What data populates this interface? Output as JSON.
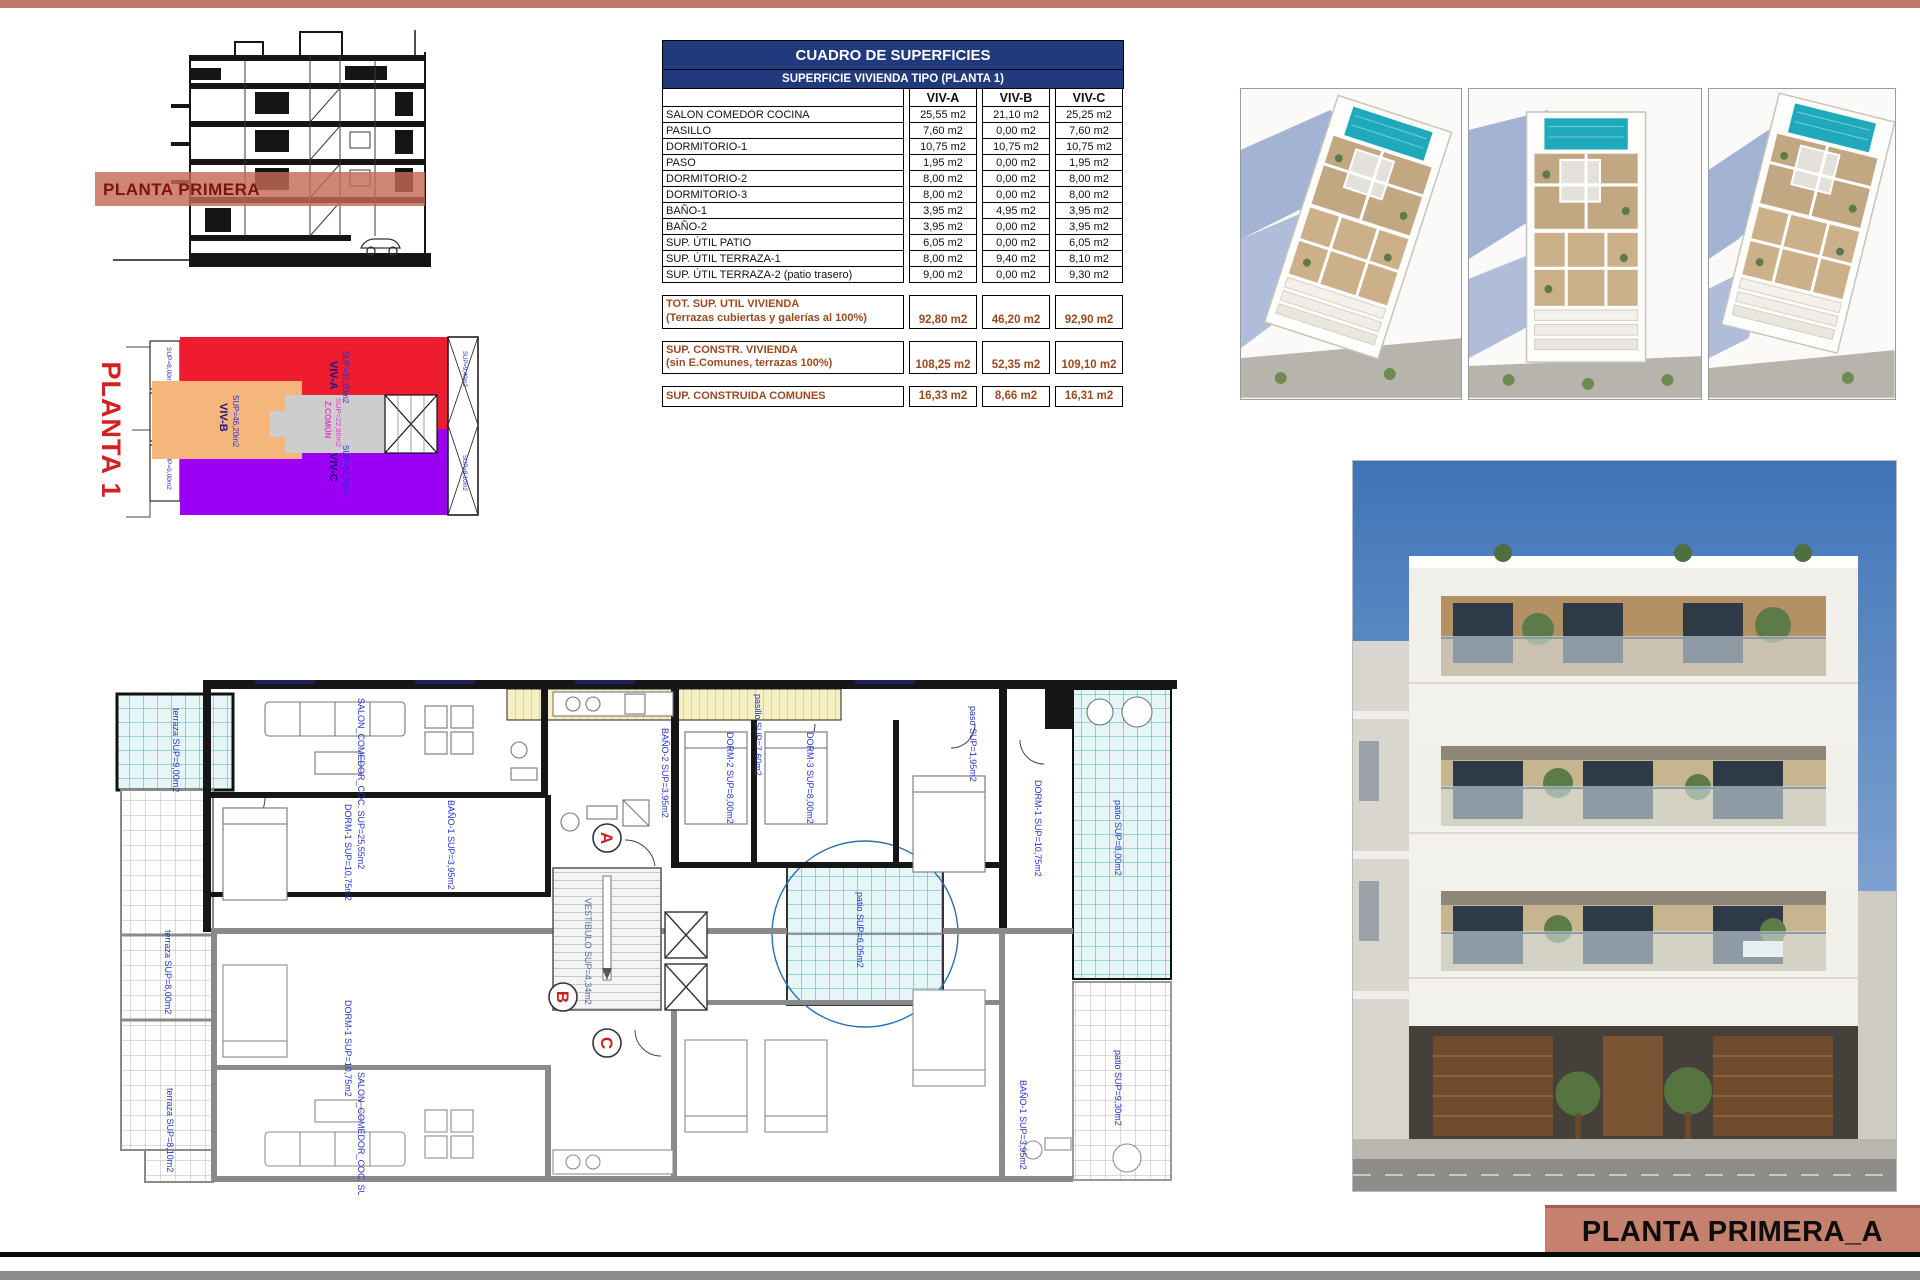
{
  "page": {
    "accent_color": "#bf7769",
    "background": "#ffffff"
  },
  "section_drawing": {
    "band_label": "PLANTA PRIMERA",
    "band_color": "#c46a58"
  },
  "key_plan": {
    "title": "PLANTA 1",
    "zones": [
      {
        "name": "VIV-A",
        "sup": "SUP=92,80m2",
        "color": "#ee1c2e"
      },
      {
        "name": "VIV-B",
        "sup": "SUP=46,20m2",
        "color": "#f5b67c"
      },
      {
        "name": "Z.COMÚN",
        "sup": "SUP=22,86m2",
        "color": "#cdcdcd"
      },
      {
        "name": "VIV-C",
        "sup": "SUP=92,90m2",
        "color": "#9b00f5"
      }
    ],
    "side_labels": [
      "SUP=8,00m2",
      "SUP=6,05m2",
      "SUP=9,00m2"
    ],
    "terrace_labels": [
      "SUP=9,40m2",
      "SUP=8,10m2"
    ]
  },
  "surfaces_table": {
    "title": "CUADRO DE SUPERFICIES",
    "subtitle": "SUPERFICIE VIVIENDA TIPO  (PLANTA 1)",
    "columns": [
      "VIV-A",
      "VIV-B",
      "VIV-C"
    ],
    "rows": [
      {
        "label": "SALON COMEDOR COCINA",
        "values": [
          "25,55 m2",
          "21,10 m2",
          "25,25 m2"
        ]
      },
      {
        "label": "PASILLO",
        "values": [
          "7,60 m2",
          "0,00 m2",
          "7,60 m2"
        ]
      },
      {
        "label": "DORMITORIO-1",
        "values": [
          "10,75 m2",
          "10,75 m2",
          "10,75 m2"
        ]
      },
      {
        "label": "PASO",
        "values": [
          "1,95 m2",
          "0,00 m2",
          "1,95 m2"
        ]
      },
      {
        "label": "DORMITORIO-2",
        "values": [
          "8,00 m2",
          "0,00 m2",
          "8,00 m2"
        ]
      },
      {
        "label": "DORMITORIO-3",
        "values": [
          "8,00 m2",
          "0,00 m2",
          "8,00 m2"
        ]
      },
      {
        "label": "BAÑO-1",
        "values": [
          "3,95 m2",
          "4,95 m2",
          "3,95 m2"
        ]
      },
      {
        "label": "BAÑO-2",
        "values": [
          "3,95 m2",
          "0,00 m2",
          "3,95 m2"
        ]
      },
      {
        "label": "SUP. ÚTIL PATIO",
        "values": [
          "6,05 m2",
          "0,00 m2",
          "6,05 m2"
        ]
      },
      {
        "label": "SUP. ÚTIL TERRAZA-1",
        "values": [
          "8,00 m2",
          "9,40 m2",
          "8,10 m2"
        ]
      },
      {
        "label": "SUP. ÚTIL TERRAZA-2 (patio trasero)",
        "values": [
          "9,00 m2",
          "0,00 m2",
          "9,30 m2"
        ]
      }
    ],
    "summary_rows": [
      {
        "label_line1": "TOT. SUP. UTIL VIVIENDA",
        "label_line2": "(Terrazas cubiertas y galerías al 100%)",
        "values": [
          "92,80 m2",
          "46,20 m2",
          "92,90 m2"
        ]
      },
      {
        "label_line1": "SUP. CONSTR. VIVIENDA",
        "label_line2": "(sin E.Comunes, terrazas 100%)",
        "values": [
          "108,25 m2",
          "52,35 m2",
          "109,10 m2"
        ]
      },
      {
        "label_line1": "SUP. CONSTRUIDA COMUNES",
        "label_line2": "",
        "values": [
          "16,33 m2",
          "8,66 m2",
          "16,31 m2"
        ]
      }
    ]
  },
  "floor_plan": {
    "unit_markers": [
      "A",
      "B",
      "C"
    ],
    "labels": [
      "terraza SUP=9,00m2",
      "terraza SUP=8,00m2",
      "SALON_COMEDOR_COC. SUP=25,55m2",
      "DORM-1 SUP=10,75m2",
      "BAÑO-1 SUP=3,95m2",
      "BAÑO-2 SUP=3,95m2",
      "DORM-2 SUP=8,00m2",
      "DORM-3 SUP=8,00m2",
      "paso SUP=1,95m2",
      "pasillo SUP=7,60m2",
      "patio SUP=6,05m2",
      "patio SUP=8,00m2",
      "DORM-1 SUP=10,75m2",
      "SALON_COMEDOR_COC. SUP=25,25m2",
      "terraza SUP=8,10m2",
      "patio SUP=9,30m2",
      "VESTIBULO SUP=4,34m2",
      "BAÑO-1 SUP=3,95m2",
      "DORM-1 SUP=10,75m2"
    ]
  },
  "title_block": {
    "label": "PLANTA PRIMERA_A"
  }
}
